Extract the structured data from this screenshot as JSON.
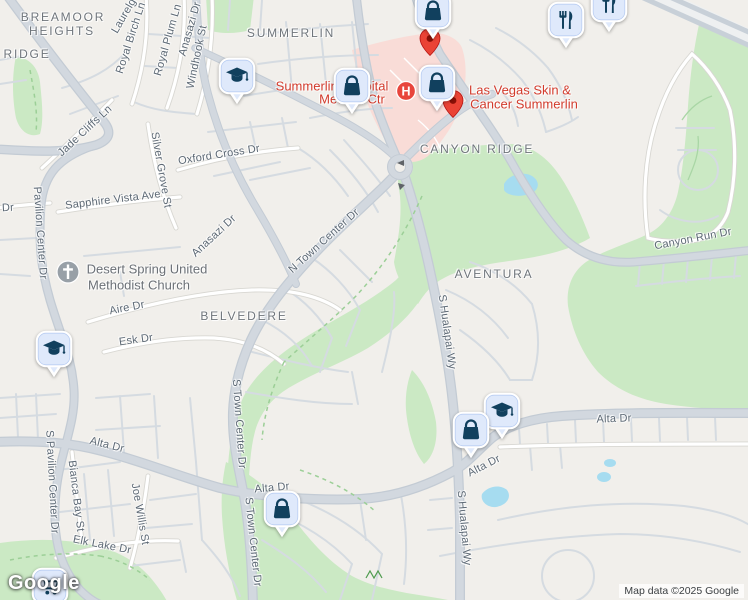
{
  "google_logo": {
    "text": "Google"
  },
  "attribution": {
    "text": "Map data ©2025 Google"
  },
  "colors": {
    "park": "#cbe9c4",
    "water": "#a6dcf0",
    "hospital_zone": "#f9dcd7",
    "road_major": "#d2d8df",
    "road_casing": "#c3cbd4",
    "marker_fill": "#dfe9fb",
    "marker_icon": "#11405e",
    "red_pin": "#ea4335",
    "hospital_red": "#e8453c",
    "poi_red_text": "#d23b2c",
    "street_text": "#5c6874",
    "area_text": "#6f757b"
  },
  "area_labels": [
    {
      "text": "BREAMOOR",
      "x": 63,
      "y": 17
    },
    {
      "text": "HEIGHTS",
      "x": 62,
      "y": 31
    },
    {
      "text": "RIDGE",
      "x": 27,
      "y": 54
    },
    {
      "text": "SUMMERLIN",
      "x": 291,
      "y": 33
    },
    {
      "text": "CANYON RIDGE",
      "x": 477,
      "y": 149
    },
    {
      "text": "AVENTURA",
      "x": 494,
      "y": 274
    },
    {
      "text": "BELVEDERE",
      "x": 244,
      "y": 316
    }
  ],
  "street_labels": [
    {
      "text": "Laurelg",
      "x": 124,
      "y": 16,
      "rot": -60
    },
    {
      "text": "Royal Birch Ln",
      "x": 131,
      "y": 38,
      "rot": -72
    },
    {
      "text": "Royal Plum Ln",
      "x": 168,
      "y": 40,
      "rot": -74
    },
    {
      "text": "Anasazi Dr",
      "x": 190,
      "y": 29,
      "rot": -74
    },
    {
      "text": "Windhook St",
      "x": 197,
      "y": 57,
      "rot": -78
    },
    {
      "text": "Jade Cliffs Ln",
      "x": 85,
      "y": 131,
      "rot": -43
    },
    {
      "text": "Silver Grove St",
      "x": 161,
      "y": 170,
      "rot": 80
    },
    {
      "text": "Oxford Cross Dr",
      "x": 219,
      "y": 155,
      "rot": -9
    },
    {
      "text": "Sapphire Vista Ave",
      "x": 113,
      "y": 200,
      "rot": -7
    },
    {
      "text": "Pavilion Center Dr",
      "x": 40,
      "y": 233,
      "rot": 86
    },
    {
      "text": "Dr",
      "x": 8,
      "y": 208,
      "rot": -3
    },
    {
      "text": "Anasazi Dr",
      "x": 214,
      "y": 236,
      "rot": -43
    },
    {
      "text": "N Town Center Dr",
      "x": 324,
      "y": 241,
      "rot": -42
    },
    {
      "text": "Aire Dr",
      "x": 127,
      "y": 308,
      "rot": -11
    },
    {
      "text": "Esk Dr",
      "x": 136,
      "y": 340,
      "rot": -8
    },
    {
      "text": "S Town Center Dr",
      "x": 239,
      "y": 424,
      "rot": 86
    },
    {
      "text": "S Town Center Dr",
      "x": 253,
      "y": 542,
      "rot": 84
    },
    {
      "text": "S Pavilion Center Dr",
      "x": 52,
      "y": 482,
      "rot": 87
    },
    {
      "text": "Bianca Bay St",
      "x": 76,
      "y": 496,
      "rot": 83
    },
    {
      "text": "Joe Willis St",
      "x": 140,
      "y": 514,
      "rot": 80
    },
    {
      "text": "Elk Lake Dr",
      "x": 102,
      "y": 545,
      "rot": 11
    },
    {
      "text": "Alta Dr",
      "x": 107,
      "y": 445,
      "rot": 14
    },
    {
      "text": "Alta Dr",
      "x": 272,
      "y": 488,
      "rot": -5
    },
    {
      "text": "Alta Dr",
      "x": 484,
      "y": 466,
      "rot": -27
    },
    {
      "text": "Alta Dr",
      "x": 614,
      "y": 419,
      "rot": -2
    },
    {
      "text": "S Hualapai Wy",
      "x": 447,
      "y": 332,
      "rot": 82
    },
    {
      "text": "S Hualapai Wy",
      "x": 464,
      "y": 528,
      "rot": 85
    },
    {
      "text": "Canyon Run Dr",
      "x": 693,
      "y": 239,
      "rot": -11
    }
  ],
  "poi_labels": [
    {
      "text": "Summerlin Hospital",
      "x": 332,
      "y": 86,
      "kind": "red"
    },
    {
      "text": "Medical Ctr",
      "x": 352,
      "y": 99,
      "kind": "red"
    },
    {
      "text": "Las Vegas Skin &",
      "x": 520,
      "y": 90,
      "kind": "red"
    },
    {
      "text": "Cancer Summerlin",
      "x": 524,
      "y": 104,
      "kind": "red"
    },
    {
      "text": "Desert Spring United",
      "x": 147,
      "y": 269,
      "kind": "gray"
    },
    {
      "text": "Methodist Church",
      "x": 139,
      "y": 285,
      "kind": "gray"
    }
  ],
  "markers": [
    {
      "icon": "graduation-cap",
      "x": 237,
      "y": 76
    },
    {
      "icon": "shopping-bag",
      "x": 352,
      "y": 86
    },
    {
      "icon": "shopping-bag",
      "x": 437,
      "y": 83,
      "red_pin": {
        "dx": 16,
        "dy": 17
      }
    },
    {
      "icon": "shopping-bag",
      "x": 433,
      "y": 11,
      "red_pin": {
        "dx": -3,
        "dy": 27
      }
    },
    {
      "icon": "restaurant",
      "x": 566,
      "y": 20
    },
    {
      "icon": "restaurant",
      "x": 609,
      "y": 4
    },
    {
      "icon": "graduation-cap",
      "x": 54,
      "y": 349
    },
    {
      "icon": "shopping-bag",
      "x": 282,
      "y": 509
    },
    {
      "icon": "graduation-cap",
      "x": 502,
      "y": 411
    },
    {
      "icon": "shopping-bag",
      "x": 471,
      "y": 430
    },
    {
      "icon": "shopping-cart",
      "x": 50,
      "y": 586
    }
  ],
  "symbols": {
    "hospital": {
      "x": 406,
      "y": 91,
      "letter": "H"
    },
    "church": {
      "x": 68,
      "y": 272
    }
  }
}
